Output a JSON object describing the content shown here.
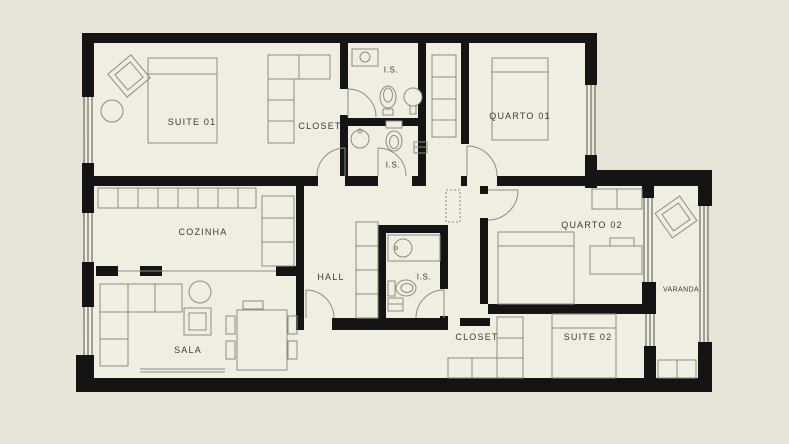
{
  "plan": {
    "type": "apartment-floor-plan",
    "labels": {
      "suite01": "SUITE 01",
      "closet01": "CLOSET",
      "is1": "I.S.",
      "is2": "I.S.",
      "quarto01": "QUARTO 01",
      "cozinha": "COZINHA",
      "hall": "HALL",
      "is3": "I.S.",
      "quarto02": "QUARTO 02",
      "varanda": "VARANDA",
      "sala": "SALA",
      "closet02": "CLOSET",
      "suite02": "SUITE 02"
    },
    "colors": {
      "page-bg": "#e8e4d7",
      "floor": "#f0ede1",
      "wall": "#141414",
      "furniture-line": "#8e8c80",
      "window-line": "#55534a",
      "label": "#3c3b35"
    }
  }
}
